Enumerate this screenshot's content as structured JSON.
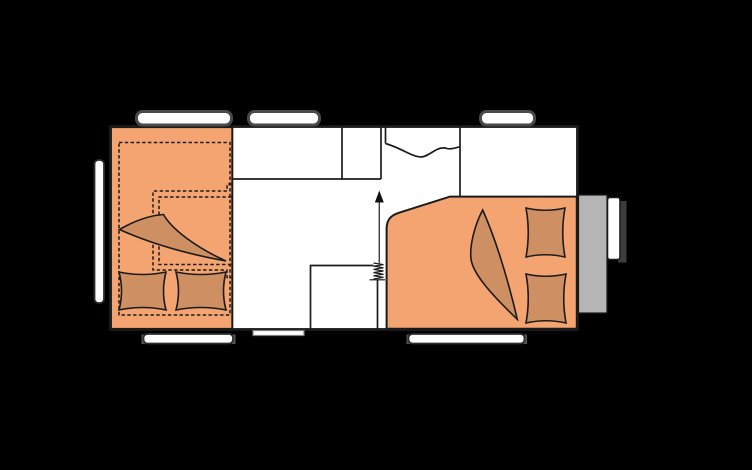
{
  "colors": {
    "background": "#000000",
    "interior": "#ffffff",
    "outline": "#1b1b1b",
    "upholstery": "#f3a471",
    "bedding": "#ce8f63",
    "front_box": "#b5b5b5",
    "hitch_shadow": "#3d3d3d",
    "window_fill": "#ffffff",
    "window_frame_dark": "#4a4a4a",
    "window_cap": "#555555",
    "arrow_head": "#111111"
  },
  "floorplan": {
    "kind": "caravan-floorplan",
    "rooms": [
      "lounge-dinette",
      "kitchen",
      "washroom",
      "fixed-double-bed"
    ],
    "features": [
      "convertible-bed-dashed-outline",
      "table-dashed-outline",
      "lounge-blanket",
      "lounge-pillows",
      "bed-blanket",
      "bed-pillows",
      "cabinet-block",
      "heater-coil",
      "entrance-arrow",
      "entry-step",
      "front-storage-box",
      "hitch-bar"
    ],
    "windows": {
      "top_count": 3,
      "bottom_count": 2,
      "rear_count": 1
    }
  }
}
